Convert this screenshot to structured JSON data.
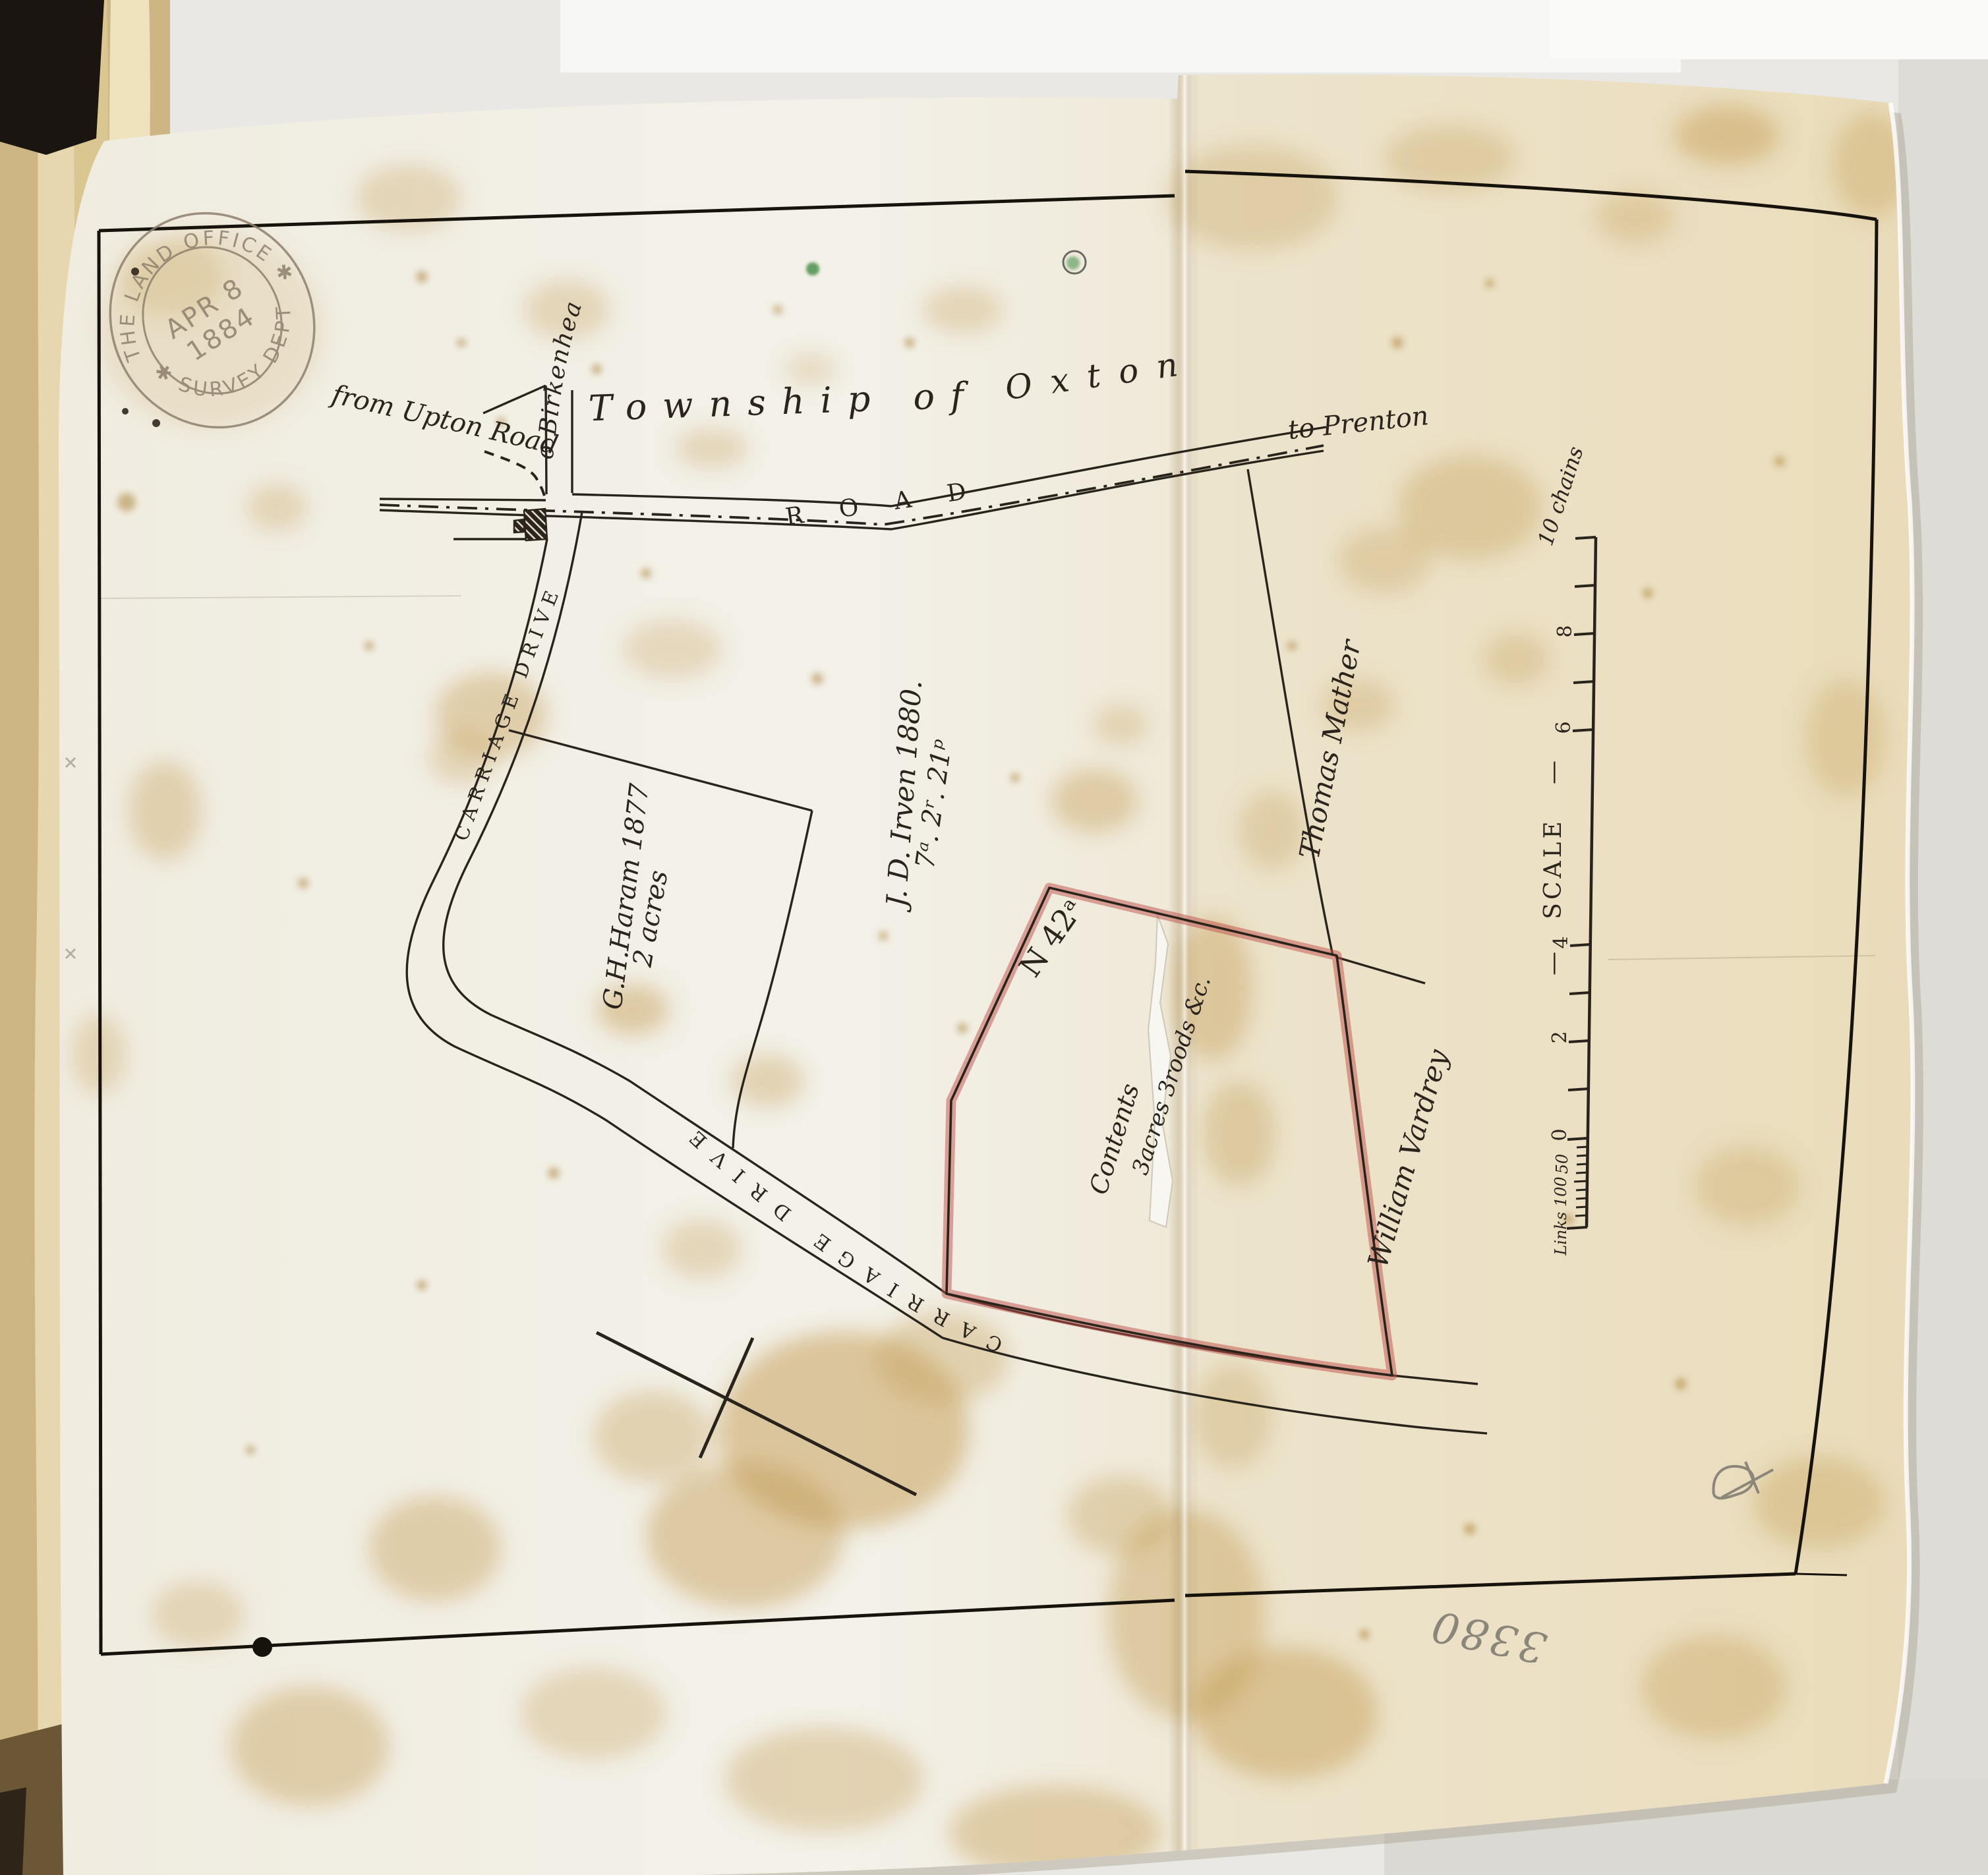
{
  "stamp": {
    "arc_top": "THE LAND OFFICE ✱",
    "arc_bottom": "✱ SURVEY DEPT",
    "date_month_day": "APR 8",
    "date_year": "1884"
  },
  "title": {
    "township_of": "Township of",
    "oxton": "Oxton"
  },
  "roads": {
    "from_upton_road": "from Upton Road",
    "to_birkenhead": "to Birkenhead",
    "to_prenton": "to Prenton",
    "road": "ROAD",
    "carriage_drive_upper": "CARRIAGE DRIVE",
    "carriage_drive_lower": "CARRIAGE DRIVE"
  },
  "parcels": {
    "haram_name": "G.H.Haram 1877",
    "haram_area": "2 acres",
    "irven_name": "J. D. Irven 1880.",
    "irven_area": "7ᵃ. 2ʳ. 21ᵖ",
    "plot_number": "N 42ᵃ",
    "contents_label": "Contents",
    "contents_value": "3acres 3roods &c.",
    "owner_east": "Thomas Mather",
    "owner_south": "William Vardrey"
  },
  "scale_bar": {
    "top_label": "10 chains",
    "chain_labels": [
      "8",
      "6",
      "4",
      "2",
      "0"
    ],
    "links_labels": [
      "50",
      "Links 100"
    ],
    "scale_word": "SCALE",
    "scale_dash": "—"
  },
  "annotations": {
    "pencil_number": "3380"
  },
  "colors": {
    "ink": "#28231b",
    "red_boundary": "#c0504a",
    "stamp_ink": "#8d7f6d",
    "pencil": "#8b867a",
    "green_mark": "#3f8a3f",
    "paper": "#f1ecdc"
  }
}
